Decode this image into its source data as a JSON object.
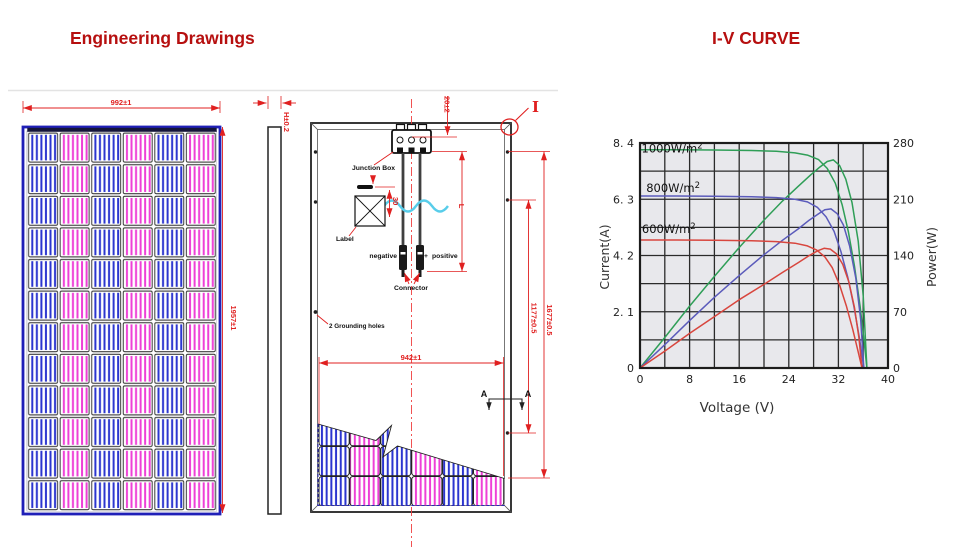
{
  "headers": {
    "engineering": "Engineering Drawings",
    "iv_curve": "I-V CURVE",
    "color": "#b60f0f"
  },
  "drawing": {
    "colors": {
      "dimension_red": "#e02020",
      "frame_blue": "#2020b8",
      "cell_blue": "#2b35cf",
      "cell_magenta": "#ee3fd7",
      "wave_cyan": "#58cdea"
    },
    "front": {
      "dim_width": "992±1",
      "dim_height": "1957±1",
      "cols": 6,
      "rows": 12
    },
    "side": {
      "dim_height": "H±0.2"
    },
    "back": {
      "dim_offset": "20±2",
      "detail_marker": "I",
      "junction_box_label": "Junction Box",
      "label_label": "Label",
      "dim_30": "30",
      "dim_L": "L",
      "negative_label": "negative",
      "minus_sign": "−",
      "plus_sign": "+",
      "positive_label": "positive",
      "connector_label": "Connector",
      "grounding_label": "2 Grounding holes",
      "dim_width": "942±1",
      "dim_1177": "1177±0.5",
      "dim_1677": "1677±0.5",
      "section_a_left": "A",
      "section_a_right": "A"
    },
    "cutaway": {
      "cols": 6,
      "rows": 3
    }
  },
  "chart_data": {
    "type": "line",
    "xlabel": "Voltage (V)",
    "ylabel_left": "Current(A)",
    "ylabel_right": "Power(W)",
    "xlim": [
      0,
      40
    ],
    "ylim_left": [
      0,
      8.4
    ],
    "ylim_right": [
      0,
      280
    ],
    "x_gridstep": 4,
    "y_gridstep_left": 1.05,
    "xticks": [
      0,
      8,
      16,
      24,
      32,
      40
    ],
    "yticks_left": [
      0,
      2.1,
      4.2,
      6.3,
      8.4
    ],
    "ytick_labels_left": [
      "0",
      "2. 1",
      "4. 2",
      "6. 3",
      "8. 4"
    ],
    "yticks_right": [
      0,
      70,
      140,
      210,
      280
    ],
    "plot_bg": "#e8e8ec",
    "grid_color": "#2b2b2b",
    "border_color": "#1c1c1c",
    "series": [
      {
        "name": "1000W/m²",
        "color": "#2f9e57",
        "label_xy": [
          0.25,
          8.05
        ],
        "iv": [
          [
            0,
            8.15
          ],
          [
            6,
            8.15
          ],
          [
            12,
            8.14
          ],
          [
            18,
            8.12
          ],
          [
            22,
            8.09
          ],
          [
            25,
            8.03
          ],
          [
            27,
            7.95
          ],
          [
            28.8,
            7.78
          ],
          [
            30.2,
            7.45
          ],
          [
            31.5,
            6.9
          ],
          [
            32.6,
            6.1
          ],
          [
            33.6,
            5.1
          ],
          [
            34.6,
            3.8
          ],
          [
            35.5,
            2.3
          ],
          [
            36.2,
            0.9
          ],
          [
            36.6,
            0
          ]
        ],
        "pv_watts": [
          [
            0,
            0
          ],
          [
            4,
            38
          ],
          [
            8,
            77
          ],
          [
            12,
            114
          ],
          [
            16,
            150
          ],
          [
            20,
            184
          ],
          [
            23,
            208
          ],
          [
            25.5,
            226
          ],
          [
            27.5,
            240
          ],
          [
            29,
            250
          ],
          [
            30.2,
            257
          ],
          [
            31.2,
            259
          ],
          [
            32.2,
            252
          ],
          [
            33.2,
            235
          ],
          [
            34.2,
            206
          ],
          [
            35.2,
            158
          ],
          [
            36,
            90
          ],
          [
            36.6,
            0
          ]
        ]
      },
      {
        "name": "800W/m²",
        "color": "#5b5bbb",
        "label_xy": [
          1.0,
          6.57
        ],
        "iv": [
          [
            0,
            6.42
          ],
          [
            6,
            6.42
          ],
          [
            12,
            6.41
          ],
          [
            18,
            6.39
          ],
          [
            22,
            6.36
          ],
          [
            25,
            6.3
          ],
          [
            27,
            6.2
          ],
          [
            28.6,
            6.0
          ],
          [
            30,
            5.65
          ],
          [
            31.3,
            5.1
          ],
          [
            32.4,
            4.35
          ],
          [
            33.5,
            3.4
          ],
          [
            34.5,
            2.3
          ],
          [
            35.4,
            1.1
          ],
          [
            36.1,
            0
          ]
        ],
        "pv_watts": [
          [
            0,
            0
          ],
          [
            4,
            29
          ],
          [
            8,
            59
          ],
          [
            12,
            88
          ],
          [
            16,
            115
          ],
          [
            20,
            141
          ],
          [
            23,
            159
          ],
          [
            25.5,
            173
          ],
          [
            27.3,
            184
          ],
          [
            28.8,
            192
          ],
          [
            29.8,
            197
          ],
          [
            30.8,
            198
          ],
          [
            31.8,
            192
          ],
          [
            32.8,
            178
          ],
          [
            33.8,
            152
          ],
          [
            34.8,
            112
          ],
          [
            35.6,
            60
          ],
          [
            36.1,
            0
          ]
        ]
      },
      {
        "name": "600W/m²",
        "color": "#d8463e",
        "label_xy": [
          0.3,
          5.04
        ],
        "iv": [
          [
            0,
            4.78
          ],
          [
            6,
            4.78
          ],
          [
            12,
            4.77
          ],
          [
            18,
            4.75
          ],
          [
            22,
            4.72
          ],
          [
            25,
            4.66
          ],
          [
            27,
            4.56
          ],
          [
            28.5,
            4.4
          ],
          [
            29.8,
            4.15
          ],
          [
            31,
            3.75
          ],
          [
            32.2,
            3.1
          ],
          [
            33.3,
            2.3
          ],
          [
            34.3,
            1.45
          ],
          [
            35.2,
            0.6
          ],
          [
            35.8,
            0
          ]
        ],
        "pv_watts": [
          [
            0,
            0
          ],
          [
            4,
            21
          ],
          [
            8,
            43
          ],
          [
            12,
            64
          ],
          [
            16,
            85
          ],
          [
            20,
            104
          ],
          [
            23,
            119
          ],
          [
            25.5,
            131
          ],
          [
            27.3,
            140
          ],
          [
            28.7,
            146
          ],
          [
            29.7,
            149
          ],
          [
            30.7,
            148
          ],
          [
            31.7,
            142
          ],
          [
            32.7,
            129
          ],
          [
            33.7,
            107
          ],
          [
            34.6,
            75
          ],
          [
            35.3,
            38
          ],
          [
            35.8,
            0
          ]
        ]
      }
    ]
  }
}
